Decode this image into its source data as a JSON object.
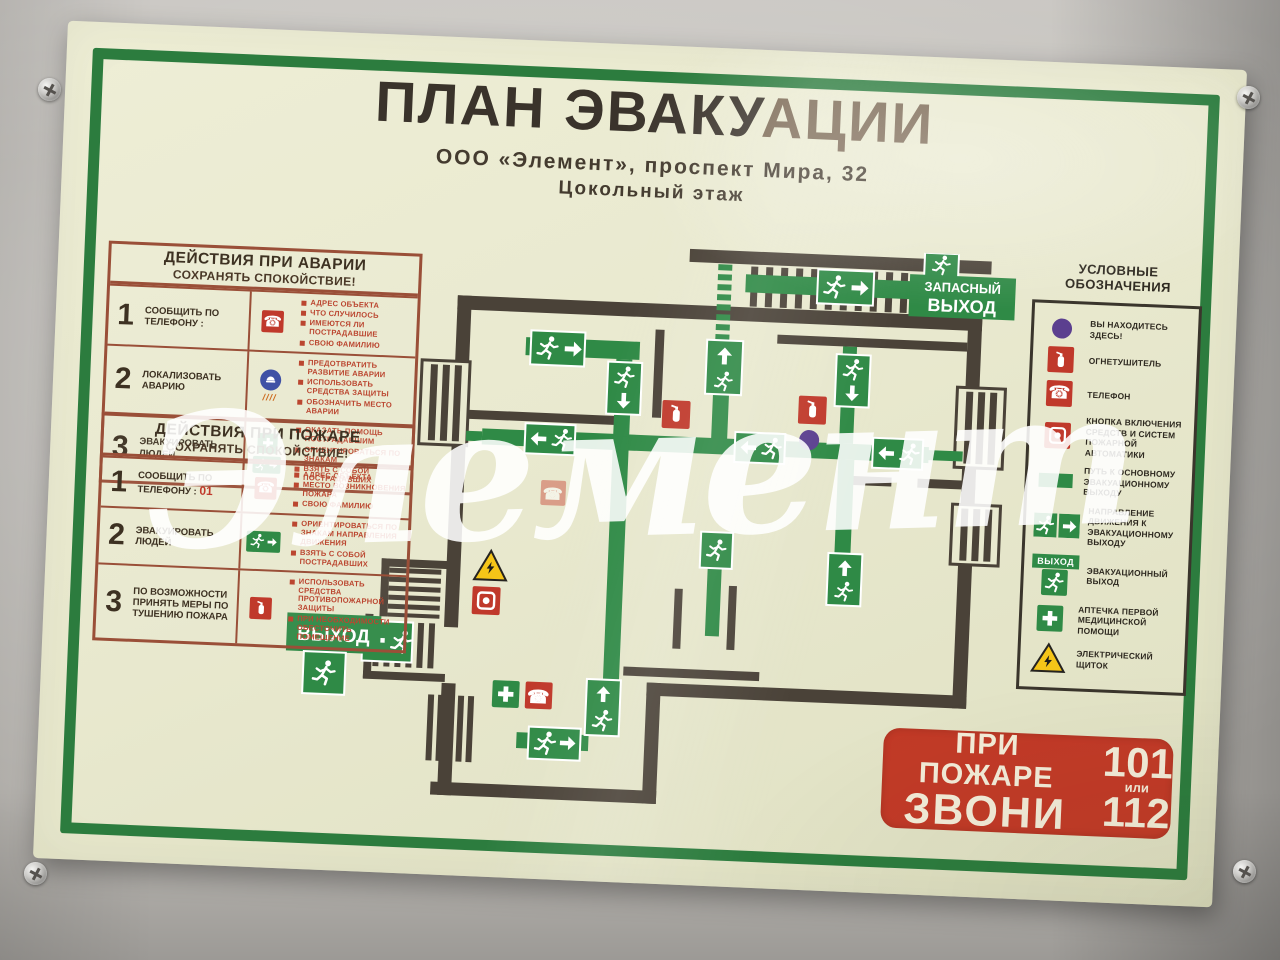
{
  "poster": {
    "title_main": "ПЛАН ЭВАКУ",
    "title_glare": "АЦИИ",
    "subtitle": "ООО  «Элемент»,  проспект  Мира,  32",
    "floor": "Цокольный  этаж"
  },
  "watermark": {
    "text": "Элемент"
  },
  "accident_table": {
    "title": "ДЕЙСТВИЯ ПРИ АВАРИИ",
    "subtitle": "СОХРАНЯТЬ СПОКОЙСТВИЕ!",
    "rows": [
      {
        "num": "1",
        "action": "СООБЩИТЬ ПО ТЕЛЕФОНУ :",
        "points": [
          "АДРЕС ОБЪЕКТА",
          "ЧТО СЛУЧИЛОСЬ",
          "ИМЕЮТСЯ ЛИ ПОСТРАДАВШИЕ",
          "СВОЮ ФАМИЛИЮ"
        ]
      },
      {
        "num": "2",
        "action": "ЛОКАЛИЗОВАТЬ АВАРИЮ",
        "points": [
          "ПРЕДОТВРАТИТЬ РАЗВИТИЕ АВАРИИ",
          "ИСПОЛЬЗОВАТЬ СРЕДСТВА ЗАЩИТЫ",
          "ОБОЗНАЧИТЬ МЕСТО АВАРИИ"
        ]
      },
      {
        "num": "3",
        "action": "ЭВАКУИРОВАТЬ ЛЮДЕЙ",
        "points": [
          "ОКАЗАТЬ ПОМОЩЬ ПОСТРАДАВШИМ",
          "ОРИЕНТИРОВАТЬСЯ ПО ЗНАКАМ",
          "ВЗЯТЬ С СОБОЙ ПОСТРАДАВШИХ"
        ]
      }
    ]
  },
  "fire_table": {
    "title": "ДЕЙСТВИЯ ПРИ ПОЖАРЕ",
    "subtitle": "СОХРАНЯТЬ СПОКОЙСТВИЕ!",
    "rows": [
      {
        "num": "1",
        "action": "СООБЩИТЬ ПО ТЕЛЕФОНУ :",
        "phone": "01",
        "points": [
          "АДРЕС ОБЪЕКТА",
          "МЕСТО ВОЗНИКНОВЕНИЯ ПОЖАРА",
          "СВОЮ ФАМИЛИЮ"
        ]
      },
      {
        "num": "2",
        "action": "ЭВАКУИРОВАТЬ ЛЮДЕЙ",
        "points": [
          "ОРИЕНТИРОВАТЬСЯ ПО ЗНАКАМ НАПРАВЛЕНИЯ ДВИЖЕНИЯ",
          "ВЗЯТЬ С СОБОЙ ПОСТРАДАВШИХ"
        ]
      },
      {
        "num": "3",
        "action": "ПО ВОЗМОЖНОСТИ ПРИНЯТЬ МЕРЫ ПО ТУШЕНИЮ ПОЖАРА",
        "points": [
          "ИСПОЛЬЗОВАТЬ СРЕДСТВА ПРОТИВОПОЖАРНОЙ ЗАЩИТЫ",
          "ПРИ НЕОБХОДИМОСТИ ОБЕСТОЧИТЬ ПОМЕЩЕНИЕ"
        ]
      }
    ]
  },
  "legend": {
    "title": "УСЛОВНЫЕ ОБОЗНАЧЕНИЯ",
    "exit_sign_label": "ВЫХОД",
    "items": [
      {
        "icon": "you-are-here-dot",
        "label": "ВЫ НАХОДИТЕСЬ ЗДЕСЬ!"
      },
      {
        "icon": "fire-extinguisher",
        "label": "ОГНЕТУШИТЕЛЬ"
      },
      {
        "icon": "telephone",
        "label": "ТЕЛЕФОН"
      },
      {
        "icon": "fire-alarm-button",
        "label": "КНОПКА ВКЛЮЧЕНИЯ СРЕДСТВ И СИСТЕМ ПОЖАРНОЙ АВТОМАТИКИ"
      },
      {
        "icon": "evacuation-path",
        "label": "ПУТЬ К ОСНОВНОМУ ЭВАКУАЦИОННОМУ ВЫХОДУ"
      },
      {
        "icon": "direction-arrow",
        "label": "НАПРАВЛЕНИЕ ДВИЖЕНИЯ К ЭВАКУАЦИОННОМУ ВЫХОДУ"
      },
      {
        "icon": "exit-sign",
        "label": "ЭВАКУАЦИОННЫЙ ВЫХОД"
      },
      {
        "icon": "first-aid-kit",
        "label": "АПТЕЧКА ПЕРВОЙ МЕДИЦИНСКОЙ ПОМОЩИ"
      },
      {
        "icon": "electrical-panel",
        "label": "ЭЛЕКТРИЧЕСКИЙ ЩИТОК"
      }
    ]
  },
  "plan": {
    "emergency_exit_line1": "ЗАПАСНЫЙ",
    "emergency_exit_line2": "ВЫХОД",
    "exit_label": "ВЫХОД"
  },
  "call_box": {
    "line1": "ПРИ ПОЖАРЕ",
    "line2": "ЗВОНИ",
    "number1": "101",
    "or_word": "или",
    "number2": "112"
  },
  "colors": {
    "path_green": "#2f8a46",
    "frame_green": "#2c7c3e",
    "wall_dark": "#4a4238",
    "alarm_red": "#c0392b",
    "you_are_here_purple": "#5b3f8f",
    "poster_cream": "#e9e9cf"
  }
}
